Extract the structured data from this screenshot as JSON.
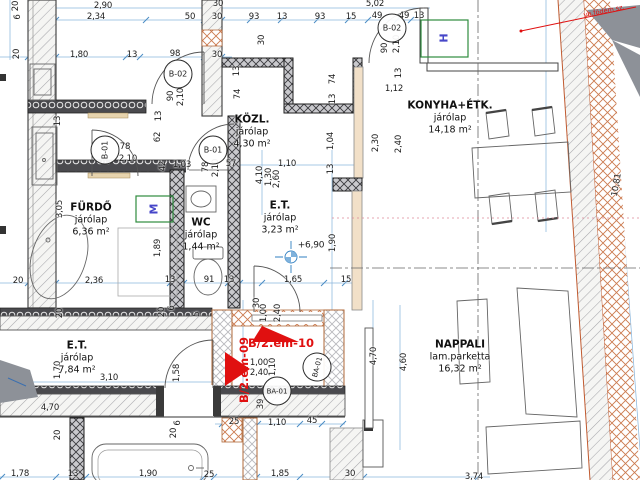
{
  "palette": {
    "red_accent": "#e01010",
    "green_window": "#2e8b3e",
    "blue_dimension": "#8ab6dc",
    "blue_letter": "#4646c8",
    "orange_wall": "#cc7a4e",
    "beige_wall": "#f2e0c8",
    "gray_shape": "#8d9198"
  },
  "rooms": [
    {
      "id": "furdo",
      "name": "FÜRDŐ",
      "finish": "járólap",
      "area": "6,36 m²",
      "x": 91,
      "y": 220
    },
    {
      "id": "wc",
      "name": "WC",
      "finish": "járólap",
      "area": "1,44 m²",
      "x": 201,
      "y": 235
    },
    {
      "id": "kozl",
      "name": "KÖZL.",
      "finish": "járólap",
      "area": "4,30 m²",
      "x": 252,
      "y": 132
    },
    {
      "id": "et-upper",
      "name": "E.T.",
      "finish": "járólap",
      "area": "3,23 m²",
      "x": 280,
      "y": 218
    },
    {
      "id": "konyha",
      "name": "KONYHA+ÉTK.",
      "finish": "járólap",
      "area": "14,18 m²",
      "x": 450,
      "y": 118
    },
    {
      "id": "et-lower",
      "name": "E.T.",
      "finish": "járólap",
      "area": "7,84 m²",
      "x": 77,
      "y": 358
    },
    {
      "id": "nappali",
      "name": "NAPPALI",
      "finish": "lam.parketta",
      "area": "16,32 m²",
      "x": 460,
      "y": 357
    }
  ],
  "door_tags": [
    {
      "label": "B-02",
      "x": 178,
      "y": 74,
      "rot": 0
    },
    {
      "label": "B-01",
      "x": 213,
      "y": 150,
      "rot": 0
    },
    {
      "label": "B-01",
      "x": 105,
      "y": 150,
      "rot": -90
    },
    {
      "label": "B-02",
      "x": 392,
      "y": 28,
      "rot": 0
    },
    {
      "label": "BA-01",
      "x": 277,
      "y": 391,
      "rot": 0
    },
    {
      "label": "BA-01",
      "x": 317,
      "y": 367,
      "rot": -75
    }
  ],
  "window_tags": [
    {
      "label": "M",
      "x": 154,
      "y": 209,
      "rot": -90
    },
    {
      "label": "H",
      "x": 444,
      "y": 38,
      "rot": -90
    }
  ],
  "red_labels": [
    {
      "text": "B/2.em-10",
      "x": 281,
      "y": 343,
      "rot": 0,
      "small": false
    },
    {
      "text": "B/2.em-09",
      "x": 244,
      "y": 370,
      "rot": -90,
      "small": false
    },
    {
      "text": "vb.födém sz.",
      "x": 604,
      "y": 11,
      "rot": -11,
      "small": true
    }
  ],
  "level_marker": {
    "text": "+6,90",
    "x": 311,
    "y": 246
  },
  "dimensions": [
    {
      "t": "2,90",
      "x": 103,
      "y": 6,
      "r": 0
    },
    {
      "t": "30",
      "x": 218,
      "y": 4,
      "r": 0
    },
    {
      "t": "5,02",
      "x": 375,
      "y": 4,
      "r": 0
    },
    {
      "t": "2,34",
      "x": 96,
      "y": 17,
      "r": 0
    },
    {
      "t": "50",
      "x": 190,
      "y": 17,
      "r": 0
    },
    {
      "t": "30",
      "x": 217,
      "y": 17,
      "r": 0
    },
    {
      "t": "93",
      "x": 254,
      "y": 17,
      "r": 0
    },
    {
      "t": "13",
      "x": 282,
      "y": 17,
      "r": 0
    },
    {
      "t": "93",
      "x": 320,
      "y": 17,
      "r": 0
    },
    {
      "t": "15",
      "x": 351,
      "y": 17,
      "r": 0
    },
    {
      "t": "49",
      "x": 377,
      "y": 16,
      "r": 0
    },
    {
      "t": "49",
      "x": 404,
      "y": 16,
      "r": 0
    },
    {
      "t": "13",
      "x": 419,
      "y": 16,
      "r": 0
    },
    {
      "t": "20",
      "x": 16,
      "y": 6,
      "r": -90
    },
    {
      "t": "6",
      "x": 18,
      "y": 17,
      "r": -90
    },
    {
      "t": "20",
      "x": 17,
      "y": 54,
      "r": -90
    },
    {
      "t": "1,80",
      "x": 79,
      "y": 55,
      "r": 0
    },
    {
      "t": "13",
      "x": 132,
      "y": 55,
      "r": 0
    },
    {
      "t": "98",
      "x": 175,
      "y": 54,
      "r": 0
    },
    {
      "t": "30",
      "x": 217,
      "y": 55,
      "r": 0
    },
    {
      "t": "90",
      "x": 171,
      "y": 96,
      "r": -90
    },
    {
      "t": "2,10",
      "x": 181,
      "y": 97,
      "r": -90
    },
    {
      "t": "13",
      "x": 58,
      "y": 121,
      "r": -90
    },
    {
      "t": "13",
      "x": 159,
      "y": 116,
      "r": -90
    },
    {
      "t": "62",
      "x": 158,
      "y": 137,
      "r": -90
    },
    {
      "t": "30",
      "x": 262,
      "y": 40,
      "r": -90
    },
    {
      "t": "13",
      "x": 237,
      "y": 71,
      "r": -90
    },
    {
      "t": "74",
      "x": 238,
      "y": 94,
      "r": -90
    },
    {
      "t": "74",
      "x": 333,
      "y": 79,
      "r": -90
    },
    {
      "t": "13",
      "x": 333,
      "y": 99,
      "r": -90
    },
    {
      "t": "13",
      "x": 399,
      "y": 73,
      "r": -90
    },
    {
      "t": "1,12",
      "x": 394,
      "y": 89,
      "r": 0
    },
    {
      "t": "90",
      "x": 385,
      "y": 48,
      "r": -90
    },
    {
      "t": "2,10",
      "x": 397,
      "y": 44,
      "r": -90
    },
    {
      "t": "1,04",
      "x": 331,
      "y": 141,
      "r": -90
    },
    {
      "t": "2,30",
      "x": 376,
      "y": 143,
      "r": -90
    },
    {
      "t": "2,40",
      "x": 399,
      "y": 144,
      "r": -90
    },
    {
      "t": "78",
      "x": 125,
      "y": 147,
      "r": 0
    },
    {
      "t": "2,10",
      "x": 128,
      "y": 159,
      "r": 0
    },
    {
      "t": "42",
      "x": 163,
      "y": 166,
      "r": -90
    },
    {
      "t": "1,03",
      "x": 182,
      "y": 165,
      "r": 0
    },
    {
      "t": "78",
      "x": 206,
      "y": 167,
      "r": -90
    },
    {
      "t": "2,10",
      "x": 216,
      "y": 168,
      "r": -90
    },
    {
      "t": "57",
      "x": 231,
      "y": 164,
      "r": 0
    },
    {
      "t": "4,10",
      "x": 260,
      "y": 175,
      "r": -90
    },
    {
      "t": "1,30",
      "x": 269,
      "y": 177,
      "r": -90
    },
    {
      "t": "2,60",
      "x": 277,
      "y": 179,
      "r": -90
    },
    {
      "t": "1,10",
      "x": 287,
      "y": 164,
      "r": 0
    },
    {
      "t": "13",
      "x": 331,
      "y": 169,
      "r": -90
    },
    {
      "t": "3,05",
      "x": 60,
      "y": 209,
      "r": -90
    },
    {
      "t": "1,89",
      "x": 158,
      "y": 248,
      "r": -90
    },
    {
      "t": "1,90",
      "x": 333,
      "y": 243,
      "r": -90
    },
    {
      "t": "20",
      "x": 18,
      "y": 281,
      "r": 0
    },
    {
      "t": "2,36",
      "x": 94,
      "y": 281,
      "r": 0
    },
    {
      "t": "13",
      "x": 170,
      "y": 280,
      "r": 0
    },
    {
      "t": "91",
      "x": 209,
      "y": 280,
      "r": 0
    },
    {
      "t": "13",
      "x": 229,
      "y": 280,
      "r": 0
    },
    {
      "t": "1,65",
      "x": 293,
      "y": 280,
      "r": 0
    },
    {
      "t": "15",
      "x": 346,
      "y": 280,
      "r": 0
    },
    {
      "t": "30",
      "x": 257,
      "y": 303,
      "r": -90
    },
    {
      "t": "1,00",
      "x": 264,
      "y": 313,
      "r": -90
    },
    {
      "t": "2,40",
      "x": 278,
      "y": 313,
      "r": -90
    },
    {
      "t": "1,00",
      "x": 259,
      "y": 363,
      "r": 0
    },
    {
      "t": "2,40",
      "x": 259,
      "y": 373,
      "r": 0
    },
    {
      "t": "1,10",
      "x": 273,
      "y": 367,
      "r": -90
    },
    {
      "t": "39",
      "x": 261,
      "y": 404,
      "r": -90
    },
    {
      "t": "25",
      "x": 234,
      "y": 422,
      "r": 0
    },
    {
      "t": "1,10",
      "x": 277,
      "y": 423,
      "r": 0
    },
    {
      "t": "45",
      "x": 312,
      "y": 421,
      "r": 0
    },
    {
      "t": "4,70",
      "x": 374,
      "y": 356,
      "r": -90
    },
    {
      "t": "20",
      "x": 60,
      "y": 313,
      "r": -90
    },
    {
      "t": "20",
      "x": 162,
      "y": 312,
      "r": -90
    },
    {
      "t": "6",
      "x": 172,
      "y": 308,
      "r": -90
    },
    {
      "t": "5",
      "x": 197,
      "y": 314,
      "r": -90
    },
    {
      "t": "1,70",
      "x": 58,
      "y": 370,
      "r": -90
    },
    {
      "t": "3,10",
      "x": 109,
      "y": 378,
      "r": 0
    },
    {
      "t": "4,70",
      "x": 50,
      "y": 408,
      "r": 0
    },
    {
      "t": "1,58",
      "x": 177,
      "y": 373,
      "r": -90
    },
    {
      "t": "20",
      "x": 58,
      "y": 435,
      "r": -90
    },
    {
      "t": "20",
      "x": 174,
      "y": 433,
      "r": -90
    },
    {
      "t": "6",
      "x": 178,
      "y": 423,
      "r": -90
    },
    {
      "t": "1,78",
      "x": 20,
      "y": 474,
      "r": 0
    },
    {
      "t": "13",
      "x": 73,
      "y": 474,
      "r": 0
    },
    {
      "t": "1,90",
      "x": 148,
      "y": 474,
      "r": 0
    },
    {
      "t": "25",
      "x": 209,
      "y": 475,
      "r": 0
    },
    {
      "t": "1,85",
      "x": 280,
      "y": 474,
      "r": 0
    },
    {
      "t": "30",
      "x": 350,
      "y": 474,
      "r": 0
    },
    {
      "t": "3,74",
      "x": 474,
      "y": 477,
      "r": 0
    },
    {
      "t": "10,81",
      "x": 617,
      "y": 185,
      "r": -80
    },
    {
      "t": "4,60",
      "x": 404,
      "y": 362,
      "r": -90
    }
  ]
}
